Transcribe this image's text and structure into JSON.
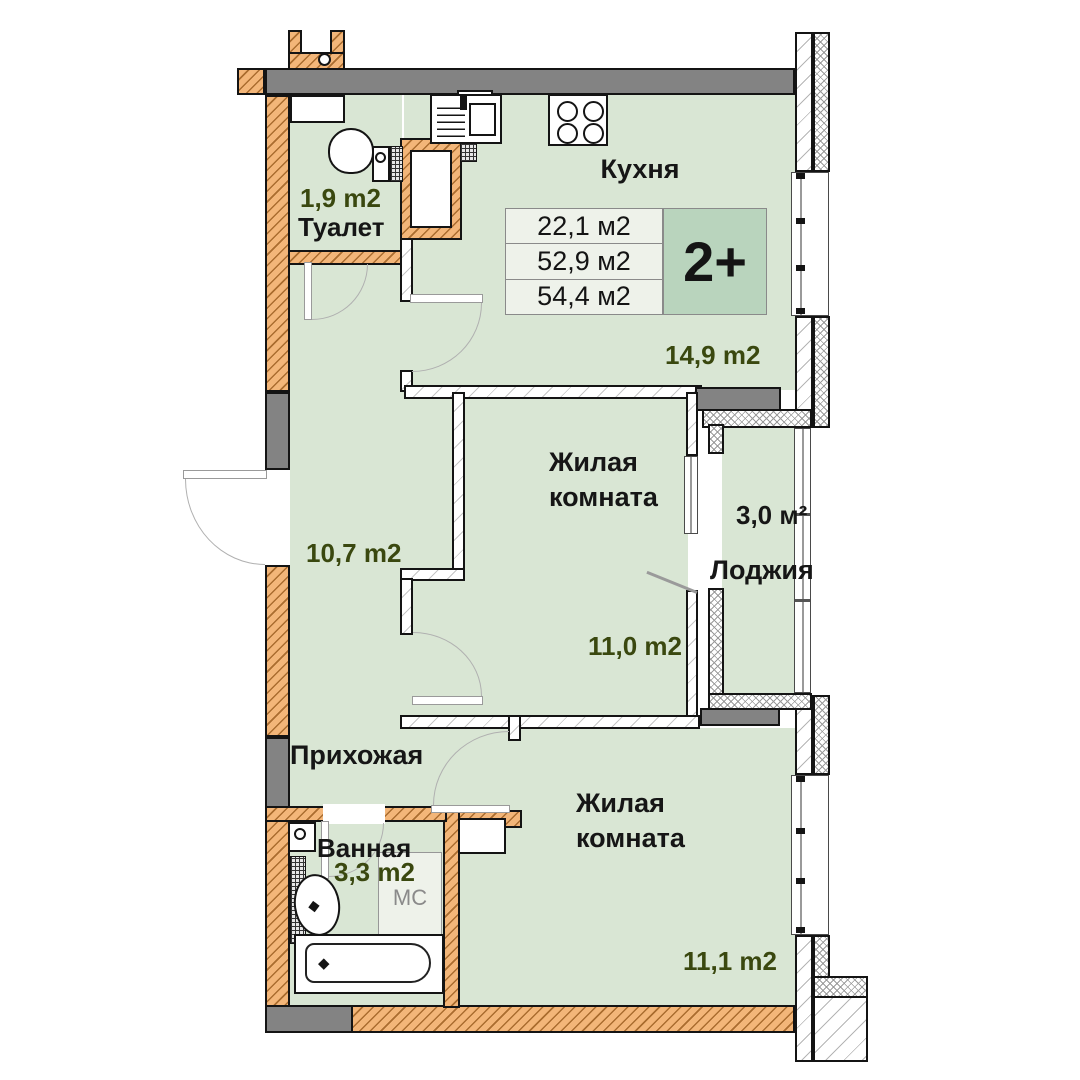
{
  "unit": {
    "badge": "2+"
  },
  "areas_table": {
    "rows": [
      "22,1 м2",
      "52,9 м2",
      "54,4 м2"
    ]
  },
  "rooms": {
    "kitchen": {
      "name": "Кухня",
      "area": "14,9 m2"
    },
    "toilet": {
      "name": "Туалет",
      "area": "1,9 m2"
    },
    "living_mid": {
      "name": "Жилая комната",
      "area": "11,0 m2"
    },
    "loggia": {
      "name": "Лоджия",
      "area": "3,0 м²"
    },
    "hallway": {
      "name": "Прихожая",
      "area": "10,7 m2"
    },
    "bathroom": {
      "name": "Ванная",
      "area": "3,3 m2"
    },
    "living_bottom": {
      "name": "Жилая комната",
      "area": "11,1 m2"
    }
  },
  "fixtures": {
    "washing_machine": "МС"
  },
  "colors": {
    "room_fill": "#d9e6d4",
    "wall_brick": "#f3b679",
    "wall_concrete": "#838383",
    "badge_fill": "#b9d4bd",
    "area_label_text": "#3a480f",
    "table_fill": "#eef2ea"
  }
}
